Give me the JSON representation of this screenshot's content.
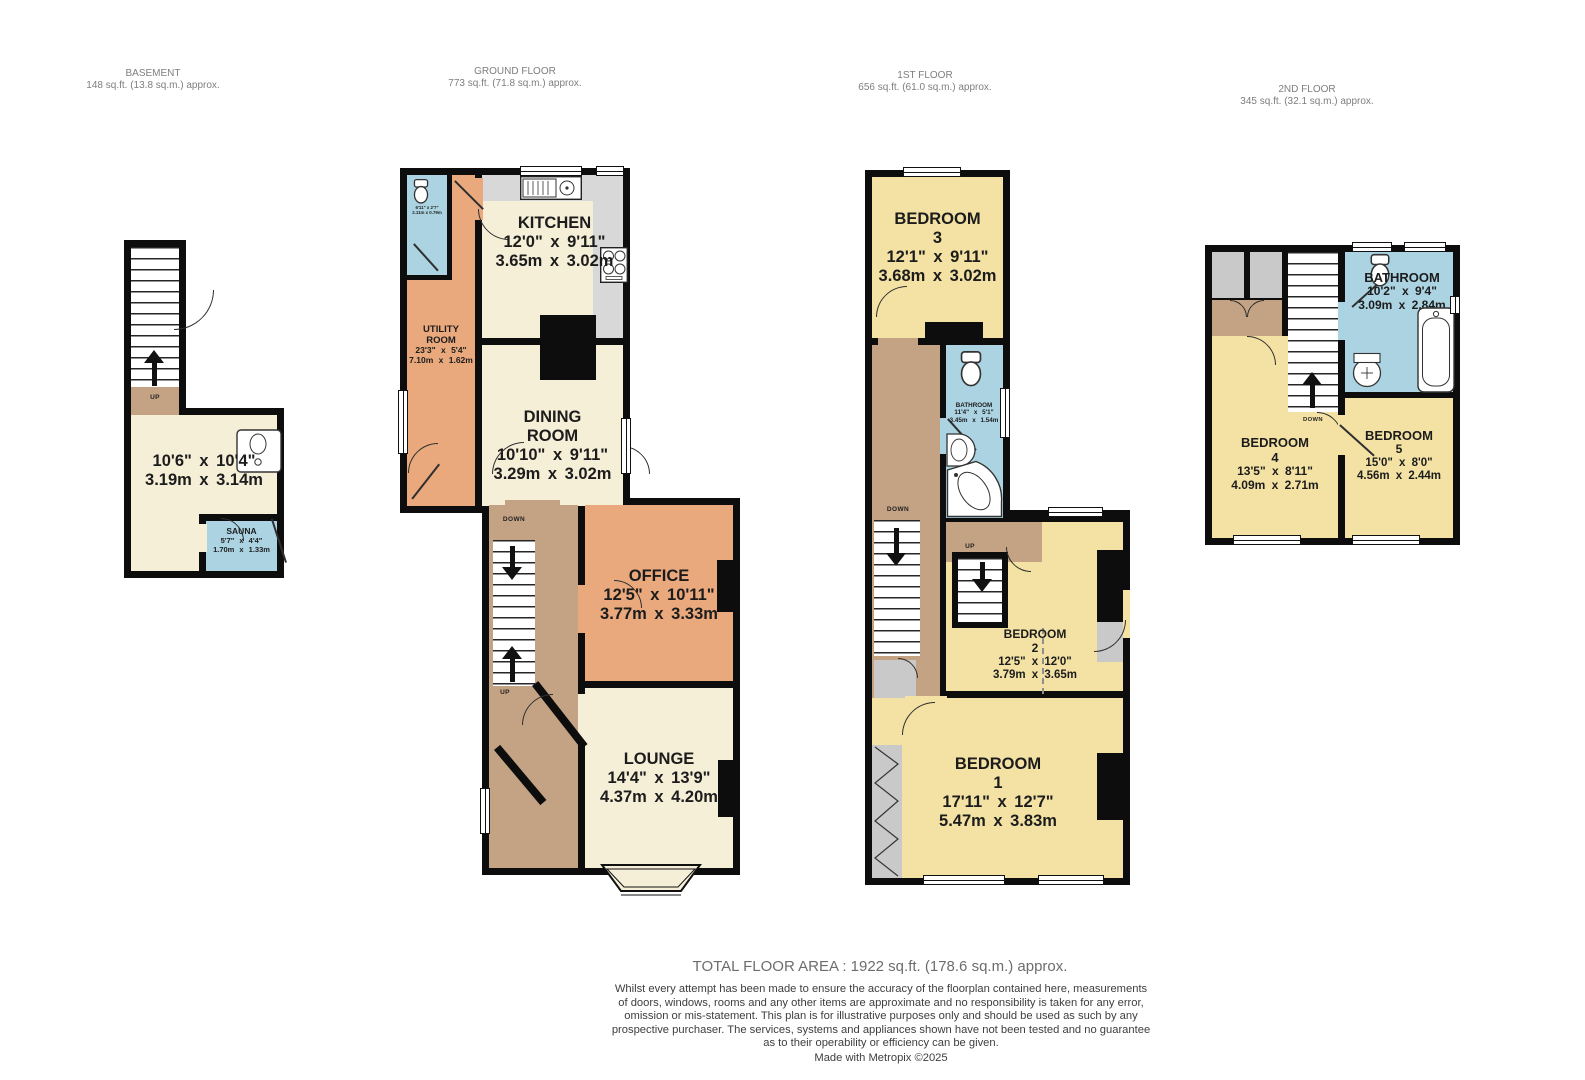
{
  "palette": {
    "wall": "#0d0d0d",
    "cream": "#f6efd8",
    "yellow": "#f3e2a4",
    "orange": "#e9a97d",
    "tan": "#c4a284",
    "blue": "#abd3e2",
    "gray": "#d2d2d2",
    "header_text": "#7e7e7e",
    "label_text": "#1c1c1c"
  },
  "headers": [
    {
      "title": "BASEMENT",
      "area": "148 sq.ft. (13.8 sq.m.) approx."
    },
    {
      "title": "GROUND FLOOR",
      "area": "773 sq.ft. (71.8 sq.m.) approx."
    },
    {
      "title": "1ST FLOOR",
      "area": "656 sq.ft. (61.0 sq.m.) approx."
    },
    {
      "title": "2ND FLOOR",
      "area": "345 sq.ft. (32.1 sq.m.) approx."
    }
  ],
  "basement": {
    "dims_ft": "10'6\" x 10'4\"",
    "dims_m": "3.19m x 3.14m",
    "sauna": {
      "name": "SAUNA",
      "ft": "5'7\" x 4'4\"",
      "m": "1.70m x 1.33m"
    },
    "up": "UP"
  },
  "ground": {
    "kitchen": {
      "name": "KITCHEN",
      "ft": "12'0\" x 9'11\"",
      "m": "3.65m x 3.02m"
    },
    "utility": {
      "name1": "UTILITY",
      "name2": "ROOM",
      "ft": "23'3\" x 5'4\"",
      "m": "7.10m x 1.62m"
    },
    "wc": {
      "ft": "6'11\" x 2'7\"",
      "m": "2.11m x 0.79m"
    },
    "dining": {
      "name1": "DINING",
      "name2": "ROOM",
      "ft": "10'10\" x 9'11\"",
      "m": "3.29m x 3.02m"
    },
    "office": {
      "name": "OFFICE",
      "ft": "12'5\" x 10'11\"",
      "m": "3.77m x 3.33m"
    },
    "lounge": {
      "name": "LOUNGE",
      "ft": "14'4\" x 13'9\"",
      "m": "4.37m x 4.20m"
    },
    "down": "DOWN",
    "up": "UP"
  },
  "first": {
    "bedroom3": {
      "name": "BEDROOM",
      "num": "3",
      "ft": "12'1\" x 9'11\"",
      "m": "3.68m x 3.02m"
    },
    "bathroom": {
      "name": "BATHROOM",
      "ft": "11'4\" x 5'1\"",
      "m": "3.45m x 1.54m"
    },
    "bedroom2": {
      "name": "BEDROOM",
      "num": "2",
      "ft": "12'5\" x 12'0\"",
      "m": "3.79m x 3.65m"
    },
    "bedroom1": {
      "name": "BEDROOM",
      "num": "1",
      "ft": "17'11\" x 12'7\"",
      "m": "5.47m x 3.83m"
    },
    "down": "DOWN",
    "up": "UP"
  },
  "second": {
    "bathroom": {
      "name": "BATHROOM",
      "ft": "10'2\" x 9'4\"",
      "m": "3.09m x 2.84m"
    },
    "bedroom4": {
      "name": "BEDROOM",
      "num": "4",
      "ft": "13'5\" x 8'11\"",
      "m": "4.09m x 2.71m"
    },
    "bedroom5": {
      "name": "BEDROOM",
      "num": "5",
      "ft": "15'0\" x 8'0\"",
      "m": "4.56m x 2.44m"
    },
    "down": "DOWN"
  },
  "footer": {
    "total": "TOTAL FLOOR AREA : 1922 sq.ft. (178.6 sq.m.) approx.",
    "disclaimer": "Whilst every attempt has been made to ensure the accuracy of the floorplan contained here, measurements\nof doors, windows, rooms and any other items are approximate and no responsibility is taken for any error,\nomission or mis-statement. This plan is for illustrative purposes only and should be used as such by any\nprospective purchaser. The services, systems and appliances shown have not been tested and no guarantee\nas to their operability or efficiency can be given.",
    "credit": "Made with Metropix ©2025"
  }
}
